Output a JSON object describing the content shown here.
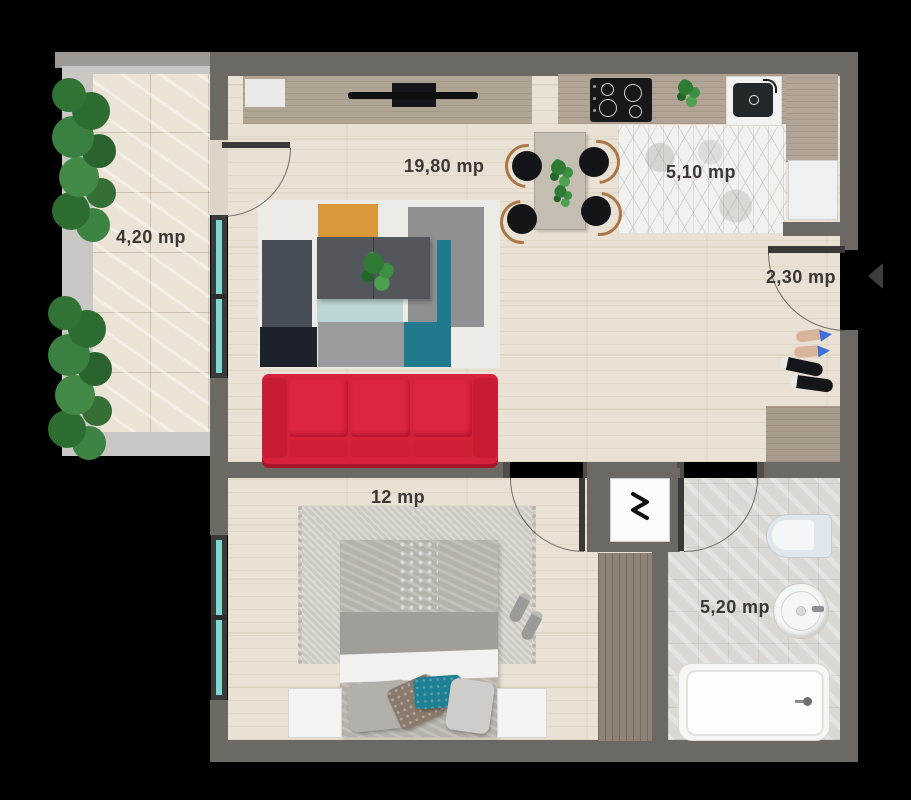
{
  "floor_plan": {
    "rooms": [
      {
        "name": "balcony",
        "area": "4,20 mp"
      },
      {
        "name": "living-room",
        "area": "19,80 mp"
      },
      {
        "name": "kitchen",
        "area": "5,10 mp"
      },
      {
        "name": "hallway",
        "area": "2,30 mp"
      },
      {
        "name": "bedroom",
        "area": "12 mp"
      },
      {
        "name": "bathroom",
        "area": "5,20 mp"
      }
    ],
    "colors": {
      "wall": "#6c6965",
      "sofa_red": "#d7203a",
      "accent_teal": "#20798c",
      "rug_orange": "#d9993b",
      "window_glass": "#80d6d0",
      "floor_wood": "#e9e2d4"
    },
    "icons": [
      {
        "name": "washing-machine-icon",
        "glyph": "zigzag-W"
      },
      {
        "name": "entrance-arrow-icon",
        "glyph": "◄"
      }
    ]
  }
}
